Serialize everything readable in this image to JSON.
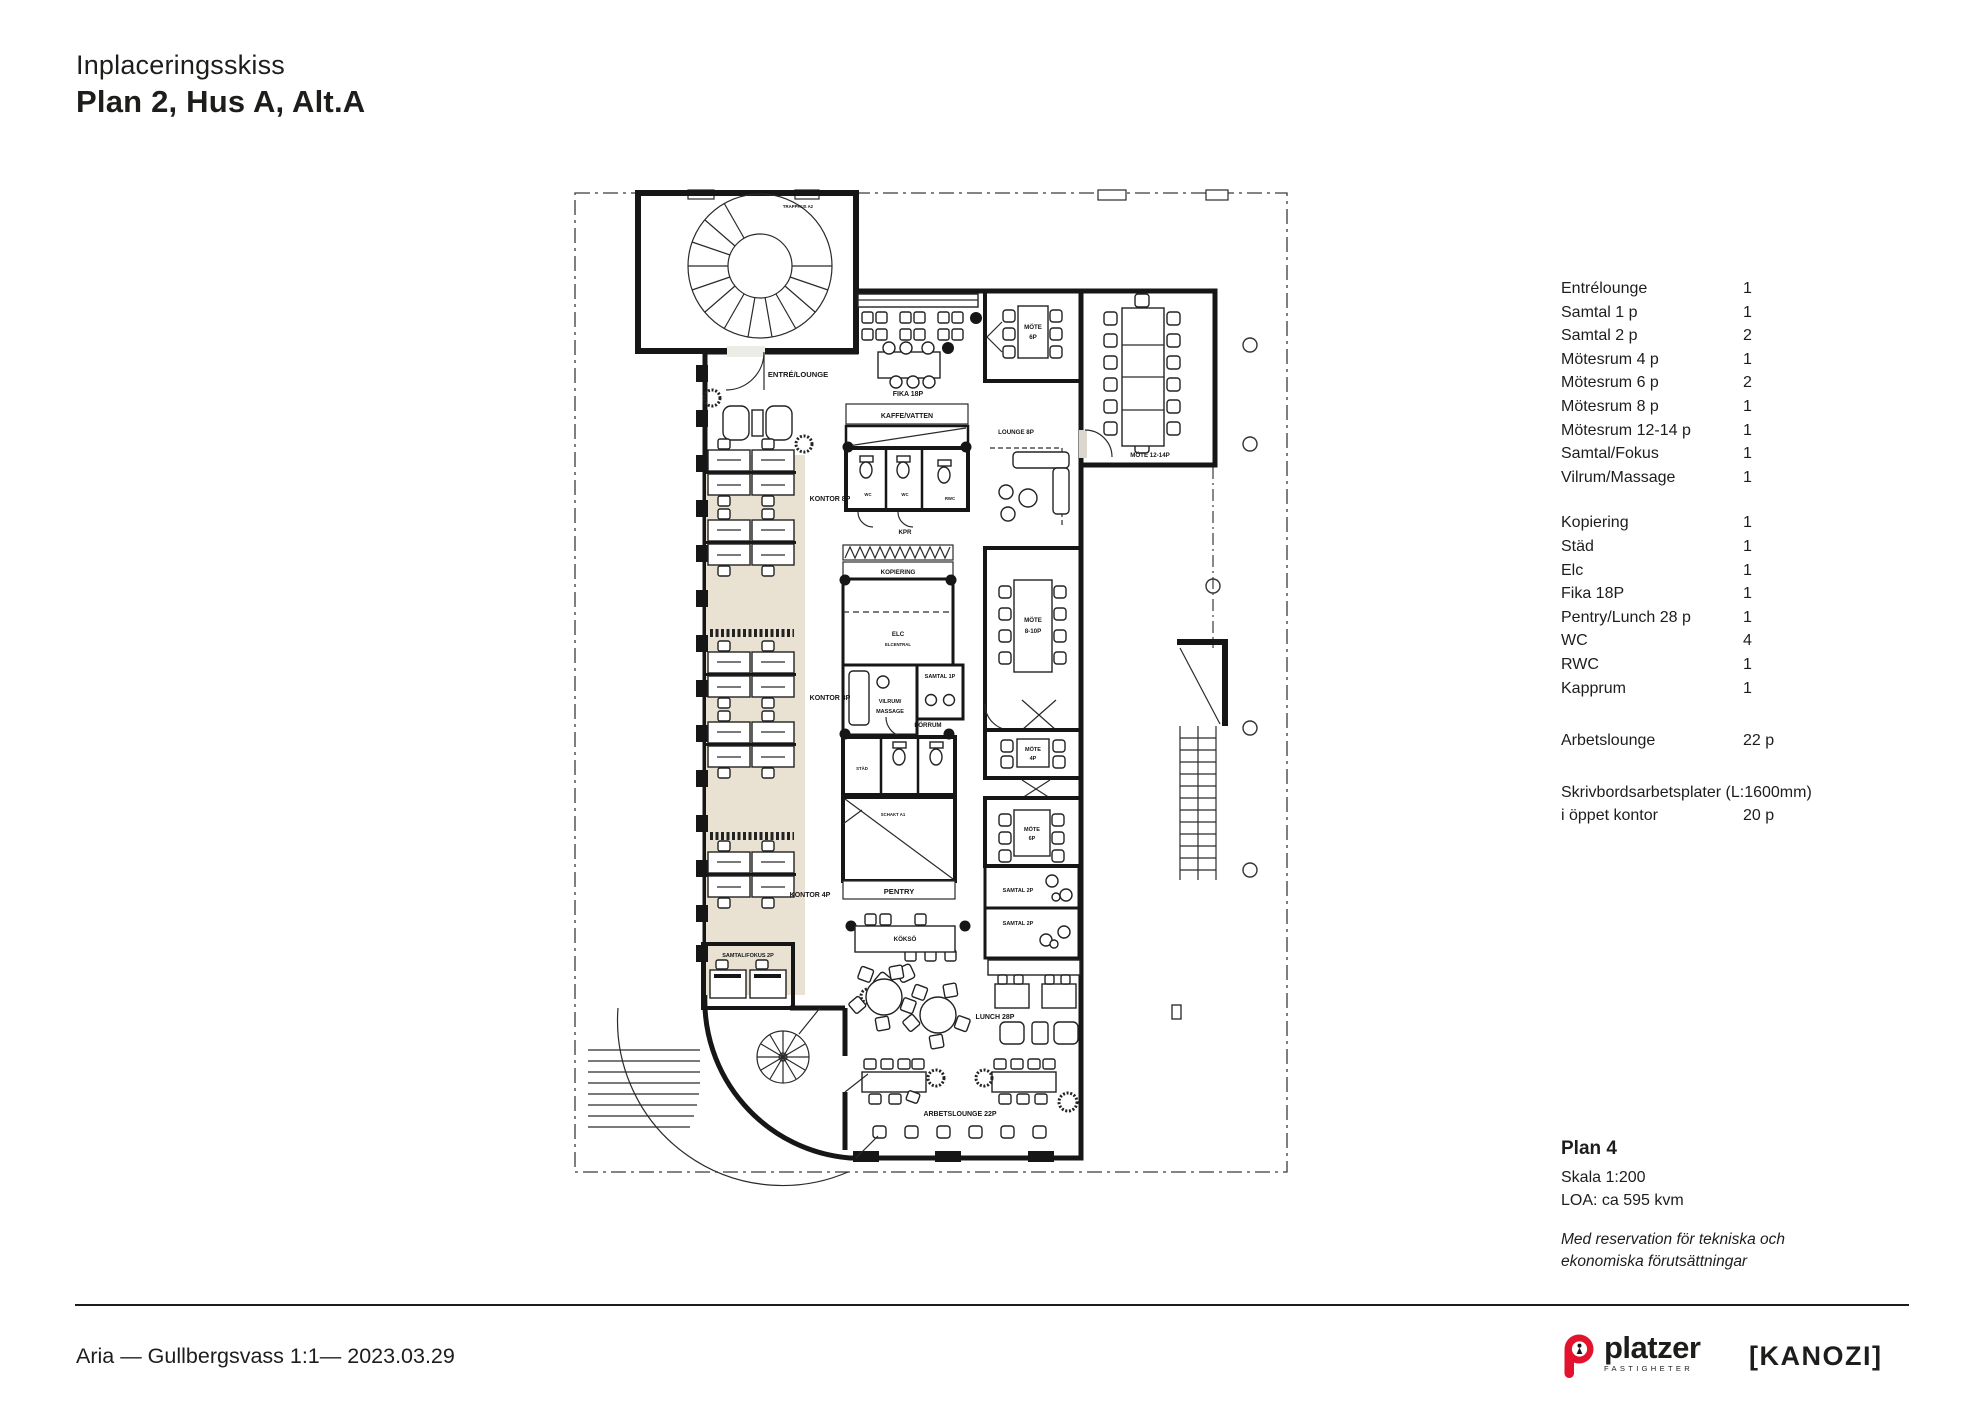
{
  "header": {
    "subtitle": "Inplaceringsskiss",
    "title": "Plan 2, Hus A, Alt.A"
  },
  "legend": {
    "groups": [
      {
        "rows": [
          {
            "label": "Entrélounge",
            "value": "1"
          },
          {
            "label": "Samtal 1 p",
            "value": "1"
          },
          {
            "label": "Samtal 2 p",
            "value": "2"
          },
          {
            "label": "Mötesrum 4 p",
            "value": "1"
          },
          {
            "label": "Mötesrum 6 p",
            "value": "2"
          },
          {
            "label": "Mötesrum 8 p",
            "value": "1"
          },
          {
            "label": "Mötesrum 12-14 p",
            "value": "1"
          },
          {
            "label": "Samtal/Fokus",
            "value": "1"
          },
          {
            "label": "Vilrum/Massage",
            "value": "1"
          }
        ]
      },
      {
        "rows": [
          {
            "label": "Kopiering",
            "value": "1"
          },
          {
            "label": "Städ",
            "value": "1"
          },
          {
            "label": "Elc",
            "value": "1"
          },
          {
            "label": "Fika 18P",
            "value": "1"
          },
          {
            "label": "Pentry/Lunch 28 p",
            "value": "1"
          },
          {
            "label": "WC",
            "value": "4"
          },
          {
            "label": "RWC",
            "value": "1"
          },
          {
            "label": "Kapprum",
            "value": "1"
          }
        ]
      },
      {
        "rows": [
          {
            "label": "Arbetslounge",
            "value": "22 p"
          }
        ]
      }
    ],
    "desks_line1": "Skrivbordsarbetsplater (L:1600mm)",
    "desks_line2_label": "i öppet kontor",
    "desks_line2_value": "20 p"
  },
  "plan_info": {
    "title": "Plan 4",
    "scale": "Skala 1:200",
    "area": "LOA: ca 595 kvm",
    "disclaimer_line1": "Med reservation för tekniska och",
    "disclaimer_line2": "ekonomiska förutsättningar"
  },
  "footer": {
    "left": "Aria — Gullbergsvass 1:1— 2023.03.29"
  },
  "logos": {
    "platzer_word": "platzer",
    "platzer_sub": "FASTIGHETER",
    "kanozi": "[KANOZI]"
  },
  "colors": {
    "accent_red": "#e3122d",
    "wall": "#161616",
    "floor": "#ecebe5",
    "kontor_zone": "#e9e2d3",
    "meeting_room": "#dbd7cf",
    "samtal_room": "#b2afbd"
  },
  "floorplan": {
    "labels": {
      "trapphus": "TRAPPHUS A2",
      "entre_lounge": "ENTRÉ/LOUNGE",
      "fika": "FIKA 18P",
      "kaffe_vatten": "KAFFE/VATTEN",
      "mote": "MÖTE",
      "mote_6p": "6P",
      "mote_12_14p": "MÖTE 12-14P",
      "lounge_8p": "LOUNGE 8P",
      "kontor_8p": "KONTOR 8P",
      "kpr": "KPR",
      "kopiering": "KOPIERING",
      "elc": "ELC",
      "elcentral": "ELCENTRAL",
      "vilrum_1": "VILRUM/",
      "vilrum_2": "MASSAGE",
      "samtal_1p": "SAMTAL 1P",
      "forrum": "FÖRRUM",
      "stad": "STÄD",
      "wc": "WC",
      "rwc": "RWC",
      "mote_810": "8-10P",
      "mote_4p": "4P",
      "samtal_2p": "SAMTAL 2P",
      "kontor_4p": "KONTOR 4P",
      "samtal_fokus": "SAMTAL/FOKUS 2P",
      "pentry": "PENTRY",
      "schakt": "SCHAKT A1",
      "kokso": "KÖKSÖ",
      "lunch": "LUNCH 28P",
      "arbetslounge": "ARBETSLOUNGE 22P"
    }
  }
}
